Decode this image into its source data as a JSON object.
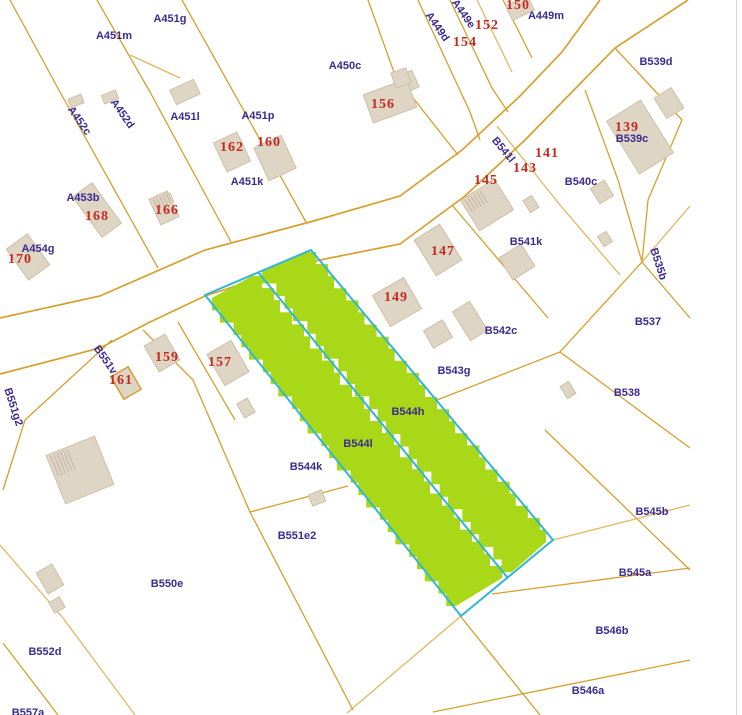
{
  "map": {
    "colors": {
      "background": "#ffffff",
      "parcel_line": "#d6a02e",
      "parcel_line_light": "#dfb863",
      "building_fill": "#ded5c5",
      "building_stroke": "#cfc0a5",
      "building_hatch": "#c3b69c",
      "highlight_fill": "#a8d818",
      "highlight_outline": "#31b6d4",
      "parcel_label": "#3b2b8f",
      "house_number": "#c5291f",
      "edge_line": "#d8d8d8"
    },
    "highlighted_parcels": [
      "B544l",
      "B544h"
    ],
    "parcel_labels": [
      {
        "text": "A451g",
        "x": 170,
        "y": 19,
        "rot": 0
      },
      {
        "text": "A451m",
        "x": 114,
        "y": 36,
        "rot": 0
      },
      {
        "text": "A449d",
        "x": 437,
        "y": 27,
        "rot": 55
      },
      {
        "text": "A449e",
        "x": 463,
        "y": 14,
        "rot": 55
      },
      {
        "text": "A449m",
        "x": 546,
        "y": 16,
        "rot": 0
      },
      {
        "text": "A450c",
        "x": 345,
        "y": 66,
        "rot": 0
      },
      {
        "text": "B539d",
        "x": 656,
        "y": 62,
        "rot": 0
      },
      {
        "text": "B539c",
        "x": 632,
        "y": 139,
        "rot": 0
      },
      {
        "text": "A452c",
        "x": 79,
        "y": 121,
        "rot": 55
      },
      {
        "text": "A452d",
        "x": 122,
        "y": 114,
        "rot": 55
      },
      {
        "text": "A451l",
        "x": 185,
        "y": 117,
        "rot": 0
      },
      {
        "text": "A451p",
        "x": 258,
        "y": 116,
        "rot": 0
      },
      {
        "text": "A451k",
        "x": 247,
        "y": 182,
        "rot": 0
      },
      {
        "text": "B541l",
        "x": 503,
        "y": 150,
        "rot": 50
      },
      {
        "text": "B540c",
        "x": 581,
        "y": 182,
        "rot": 0
      },
      {
        "text": "A453b",
        "x": 83,
        "y": 198,
        "rot": 0
      },
      {
        "text": "A454g",
        "x": 38,
        "y": 249,
        "rot": 0
      },
      {
        "text": "B541k",
        "x": 526,
        "y": 242,
        "rot": 0
      },
      {
        "text": "B535b",
        "x": 658,
        "y": 264,
        "rot": 72
      },
      {
        "text": "B537",
        "x": 648,
        "y": 322,
        "rot": 0
      },
      {
        "text": "B542c",
        "x": 501,
        "y": 331,
        "rot": 0
      },
      {
        "text": "B543g",
        "x": 454,
        "y": 371,
        "rot": 0
      },
      {
        "text": "B538",
        "x": 627,
        "y": 393,
        "rot": 0
      },
      {
        "text": "B551v",
        "x": 105,
        "y": 360,
        "rot": 55
      },
      {
        "text": "B551g2",
        "x": 13,
        "y": 407,
        "rot": 72
      },
      {
        "text": "B544h",
        "x": 408,
        "y": 412,
        "rot": 0
      },
      {
        "text": "B544l",
        "x": 358,
        "y": 444,
        "rot": 0
      },
      {
        "text": "B544k",
        "x": 306,
        "y": 467,
        "rot": 0
      },
      {
        "text": "B545b",
        "x": 652,
        "y": 512,
        "rot": 0
      },
      {
        "text": "B551e2",
        "x": 297,
        "y": 536,
        "rot": 0
      },
      {
        "text": "B545a",
        "x": 635,
        "y": 573,
        "rot": 0
      },
      {
        "text": "B550e",
        "x": 167,
        "y": 584,
        "rot": 0
      },
      {
        "text": "B546b",
        "x": 612,
        "y": 631,
        "rot": 0
      },
      {
        "text": "B552d",
        "x": 45,
        "y": 652,
        "rot": 0
      },
      {
        "text": "B546a",
        "x": 588,
        "y": 691,
        "rot": 0
      },
      {
        "text": "B557a",
        "x": 28,
        "y": 713,
        "rot": 0
      }
    ],
    "house_numbers": [
      {
        "text": "150",
        "x": 518,
        "y": 6
      },
      {
        "text": "152",
        "x": 487,
        "y": 26
      },
      {
        "text": "154",
        "x": 465,
        "y": 43
      },
      {
        "text": "156",
        "x": 383,
        "y": 105
      },
      {
        "text": "139",
        "x": 627,
        "y": 128
      },
      {
        "text": "141",
        "x": 547,
        "y": 154
      },
      {
        "text": "143",
        "x": 525,
        "y": 169
      },
      {
        "text": "145",
        "x": 486,
        "y": 181
      },
      {
        "text": "160",
        "x": 269,
        "y": 143
      },
      {
        "text": "162",
        "x": 232,
        "y": 148
      },
      {
        "text": "166",
        "x": 167,
        "y": 211
      },
      {
        "text": "168",
        "x": 97,
        "y": 217
      },
      {
        "text": "170",
        "x": 20,
        "y": 260
      },
      {
        "text": "147",
        "x": 443,
        "y": 252
      },
      {
        "text": "149",
        "x": 396,
        "y": 298
      },
      {
        "text": "159",
        "x": 167,
        "y": 358
      },
      {
        "text": "157",
        "x": 220,
        "y": 363
      },
      {
        "text": "161",
        "x": 121,
        "y": 381
      }
    ],
    "road_edges": [
      [
        [
          0,
          318
        ],
        [
          100,
          296
        ],
        [
          205,
          250
        ],
        [
          310,
          222
        ],
        [
          400,
          196
        ],
        [
          462,
          150
        ],
        [
          520,
          96
        ],
        [
          562,
          52
        ],
        [
          600,
          0
        ]
      ],
      [
        [
          0,
          374
        ],
        [
          100,
          348
        ],
        [
          150,
          322
        ],
        [
          205,
          296
        ],
        [
          310,
          262
        ],
        [
          400,
          244
        ],
        [
          465,
          196
        ],
        [
          525,
          140
        ],
        [
          615,
          48
        ],
        [
          688,
          0
        ]
      ]
    ],
    "parcel_lines": [
      [
        [
          10,
          0
        ],
        [
          60,
          92
        ],
        [
          158,
          268
        ]
      ],
      [
        [
          97,
          0
        ],
        [
          150,
          92
        ],
        [
          231,
          242
        ]
      ],
      [
        [
          182,
          0
        ],
        [
          306,
          222
        ]
      ],
      [
        [
          130,
          55
        ],
        [
          180,
          78
        ]
      ],
      [
        [
          368,
          0
        ],
        [
          395,
          75
        ],
        [
          458,
          155
        ]
      ],
      [
        [
          418,
          0
        ],
        [
          470,
          112
        ],
        [
          480,
          140
        ]
      ],
      [
        [
          450,
          0
        ],
        [
          492,
          88
        ],
        [
          508,
          112
        ]
      ],
      [
        [
          477,
          0
        ],
        [
          512,
          72
        ]
      ],
      [
        [
          503,
          0
        ],
        [
          532,
          58
        ]
      ],
      [
        [
          615,
          48
        ],
        [
          682,
          120
        ]
      ],
      [
        [
          682,
          120
        ],
        [
          648,
          200
        ],
        [
          642,
          262
        ]
      ],
      [
        [
          642,
          262
        ],
        [
          690,
          206
        ]
      ],
      [
        [
          642,
          262
        ],
        [
          690,
          318
        ]
      ],
      [
        [
          642,
          262
        ],
        [
          560,
          352
        ],
        [
          437,
          400
        ]
      ],
      [
        [
          585,
          90
        ],
        [
          618,
          180
        ],
        [
          642,
          262
        ]
      ],
      [
        [
          497,
          126
        ],
        [
          560,
          205
        ],
        [
          620,
          275
        ]
      ],
      [
        [
          452,
          205
        ],
        [
          548,
          318
        ]
      ],
      [
        [
          560,
          352
        ],
        [
          690,
          448
        ]
      ],
      [
        [
          545,
          430
        ],
        [
          690,
          570
        ]
      ],
      [
        [
          553,
          540
        ],
        [
          690,
          505
        ]
      ],
      [
        [
          492,
          594
        ],
        [
          690,
          568
        ]
      ],
      [
        [
          433,
          712
        ],
        [
          690,
          660
        ]
      ],
      [
        [
          461,
          617
        ],
        [
          540,
          715
        ]
      ],
      [
        [
          553,
          540
        ],
        [
          461,
          616
        ],
        [
          347,
          713
        ]
      ],
      [
        [
          143,
          330
        ],
        [
          193,
          380
        ],
        [
          250,
          512
        ],
        [
          353,
          710
        ]
      ],
      [
        [
          250,
          512
        ],
        [
          348,
          486
        ]
      ],
      [
        [
          112,
          340
        ],
        [
          25,
          420
        ],
        [
          3,
          490
        ]
      ],
      [
        [
          0,
          545
        ],
        [
          63,
          618
        ],
        [
          135,
          715
        ]
      ],
      [
        [
          3,
          643
        ],
        [
          58,
          715
        ]
      ],
      [
        [
          178,
          322
        ],
        [
          235,
          420
        ]
      ]
    ],
    "buildings": [
      {
        "cx": 520,
        "cy": 8,
        "w": 24,
        "h": 16,
        "rot": -25
      },
      {
        "cx": 410,
        "cy": 81,
        "w": 12,
        "h": 18,
        "rot": -25
      },
      {
        "cx": 390,
        "cy": 101,
        "w": 46,
        "h": 30,
        "rot": -20
      },
      {
        "cx": 401,
        "cy": 78,
        "w": 16,
        "h": 16,
        "rot": -20
      },
      {
        "cx": 76,
        "cy": 101,
        "w": 14,
        "h": 9,
        "rot": -22
      },
      {
        "cx": 110,
        "cy": 97,
        "w": 15,
        "h": 9,
        "rot": -22
      },
      {
        "cx": 185,
        "cy": 92,
        "w": 26,
        "h": 16,
        "rot": -25
      },
      {
        "cx": 232,
        "cy": 152,
        "w": 26,
        "h": 32,
        "rot": -25
      },
      {
        "cx": 275,
        "cy": 158,
        "w": 30,
        "h": 36,
        "rot": -25
      },
      {
        "cx": 164,
        "cy": 208,
        "w": 20,
        "h": 28,
        "rot": -25,
        "hatch": true
      },
      {
        "cx": 97,
        "cy": 210,
        "w": 24,
        "h": 50,
        "rot": -36
      },
      {
        "cx": 28,
        "cy": 257,
        "w": 26,
        "h": 38,
        "rot": -36
      },
      {
        "cx": 640,
        "cy": 137,
        "w": 40,
        "h": 62,
        "rot": -32
      },
      {
        "cx": 669,
        "cy": 103,
        "w": 20,
        "h": 24,
        "rot": -32
      },
      {
        "cx": 487,
        "cy": 205,
        "w": 40,
        "h": 36,
        "rot": -32,
        "hatch": true
      },
      {
        "cx": 602,
        "cy": 192,
        "w": 16,
        "h": 18,
        "rot": -32
      },
      {
        "cx": 605,
        "cy": 239,
        "w": 10,
        "h": 12,
        "rot": -32
      },
      {
        "cx": 531,
        "cy": 204,
        "w": 10,
        "h": 14,
        "rot": -32
      },
      {
        "cx": 517,
        "cy": 262,
        "w": 26,
        "h": 26,
        "rot": -32
      },
      {
        "cx": 438,
        "cy": 250,
        "w": 30,
        "h": 42,
        "rot": -32
      },
      {
        "cx": 397,
        "cy": 302,
        "w": 36,
        "h": 36,
        "rot": -30
      },
      {
        "cx": 438,
        "cy": 334,
        "w": 22,
        "h": 20,
        "rot": -30
      },
      {
        "cx": 470,
        "cy": 321,
        "w": 20,
        "h": 34,
        "rot": -32
      },
      {
        "cx": 228,
        "cy": 363,
        "w": 28,
        "h": 36,
        "rot": -30
      },
      {
        "cx": 246,
        "cy": 408,
        "w": 12,
        "h": 16,
        "rot": -30
      },
      {
        "cx": 162,
        "cy": 353,
        "w": 24,
        "h": 30,
        "rot": -30
      },
      {
        "cx": 126,
        "cy": 383,
        "w": 20,
        "h": 26,
        "rot": -30,
        "outline": true
      },
      {
        "cx": 80,
        "cy": 470,
        "w": 52,
        "h": 52,
        "rot": -22,
        "hatch": true
      },
      {
        "cx": 50,
        "cy": 579,
        "w": 18,
        "h": 24,
        "rot": -30
      },
      {
        "cx": 57,
        "cy": 605,
        "w": 12,
        "h": 12,
        "rot": -30
      },
      {
        "cx": 317,
        "cy": 498,
        "w": 14,
        "h": 12,
        "rot": -22
      },
      {
        "cx": 568,
        "cy": 390,
        "w": 10,
        "h": 14,
        "rot": -32
      },
      {
        "cx": 346,
        "cy": 426,
        "w": 14,
        "h": 16,
        "rot": -30,
        "white": true
      }
    ],
    "highlight": {
      "outline": [
        [
          205,
          295
        ],
        [
          311,
          250
        ],
        [
          553,
          540
        ],
        [
          461,
          616
        ]
      ],
      "divider": [
        [
          258,
          272
        ],
        [
          507,
          577
        ]
      ],
      "strips": [
        {
          "tl": [
            212,
            298
          ],
          "tr": [
            252,
            276
          ],
          "br": [
            502,
            578
          ],
          "bl": [
            456,
            606
          ]
        },
        {
          "tl": [
            264,
            271
          ],
          "tr": [
            306,
            252
          ],
          "br": [
            548,
            542
          ],
          "bl": [
            512,
            572
          ]
        }
      ]
    }
  }
}
